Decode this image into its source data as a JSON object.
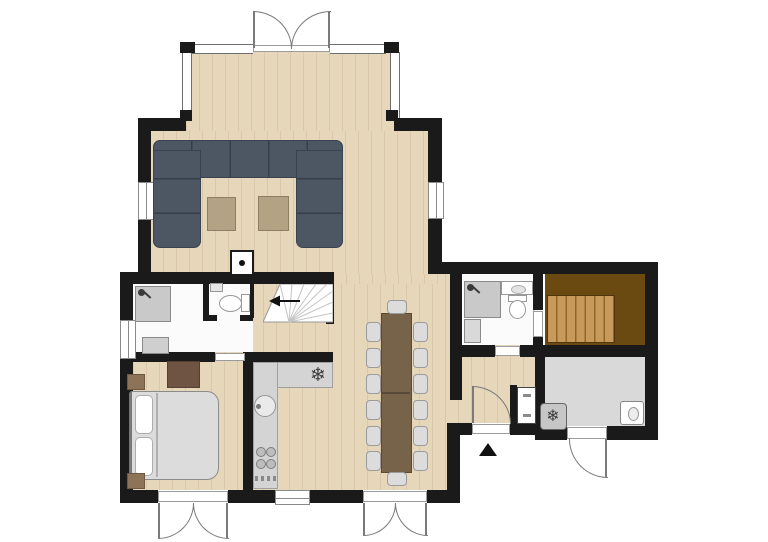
{
  "colors": {
    "wall": "#1a1a1a",
    "wood_floor": "#e7d7ba",
    "bathroom_floor": "#fbfbfb",
    "utility_floor": "#d9d9d9",
    "sofa": "#4d5663",
    "sofa_line": "#394250",
    "coffee_table": "#b3a284",
    "fixture_gray": "#c9c9c9",
    "counter": "#d4d4d4",
    "dining_table": "#77624a",
    "dining_table_edge": "#5b4933",
    "chair": "#dcdcdc",
    "bed_duvet": "#dcdcdc",
    "pillow": "#ffffff",
    "nightstand": "#8d7458",
    "dresser": "#6f5444",
    "stairs_wood_dark": "#6b4a12",
    "stairs_tread": "#c79a5c",
    "door_arc": "#7a7a7a",
    "window_frame": "#8a8a8a",
    "glass_wall": "#6e6e6e",
    "marker": "#111111"
  },
  "icons": {
    "snowflake": "❄"
  }
}
